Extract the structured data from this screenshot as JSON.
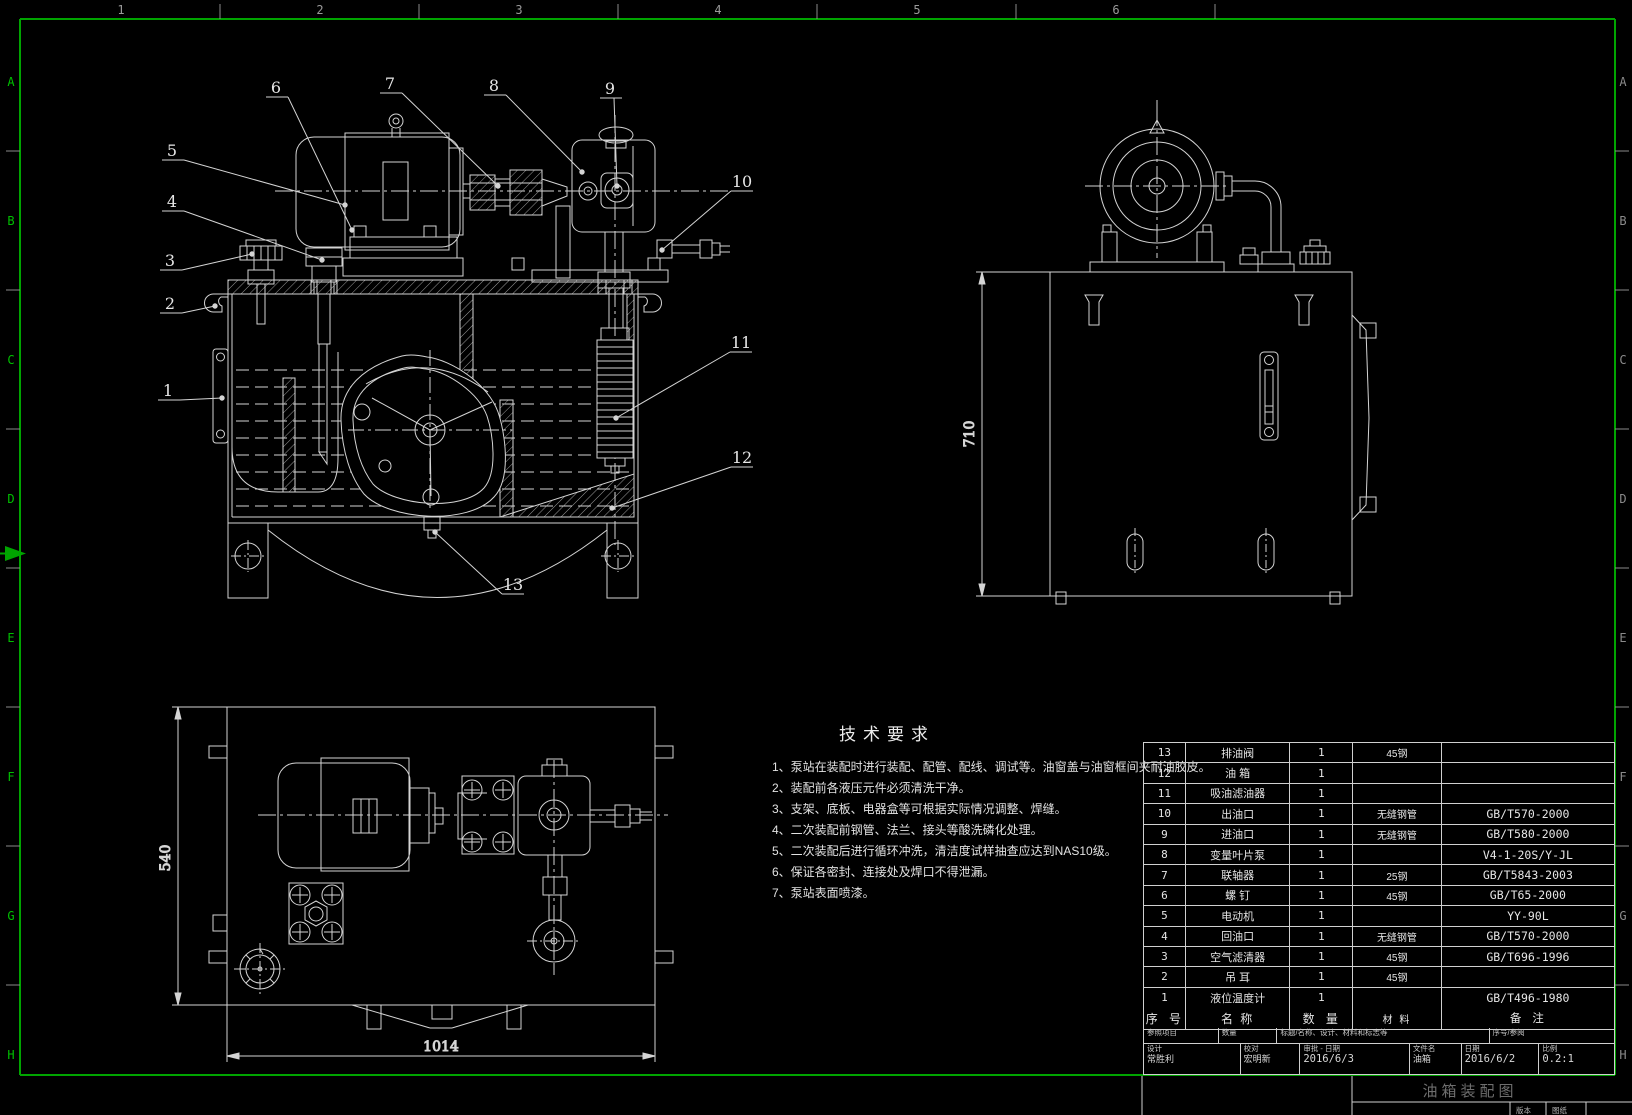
{
  "frame": {
    "columns": [
      "1",
      "2",
      "3",
      "4",
      "5",
      "6"
    ],
    "rows_left": [
      "A",
      "B",
      "C",
      "D",
      "E",
      "F",
      "G",
      "H"
    ],
    "rows_right": [
      "A",
      "B",
      "C",
      "D",
      "E",
      "F",
      "G",
      "H"
    ]
  },
  "tech_requirements": {
    "title": "技术要求",
    "items": [
      "1、泵站在装配时进行装配、配管、配线、调试等。油窗盖与油窗框间夹耐油胶皮。",
      "2、装配前各液压元件必须清洗干净。",
      "3、支架、底板、电器盒等可根据实际情况调整、焊缝。",
      "4、二次装配前钢管、法兰、接头等酸洗磷化处理。",
      "5、二次装配后进行循环冲洗，清洁度试样抽查应达到NAS10级。",
      "6、保证各密封、连接处及焊口不得泄漏。",
      "7、泵站表面喷漆。"
    ]
  },
  "front_view": {
    "balloons": [
      "1",
      "2",
      "3",
      "4",
      "5",
      "6",
      "7",
      "8",
      "9",
      "10",
      "11",
      "12",
      "13"
    ]
  },
  "side_view": {
    "height_dim": "710"
  },
  "top_view": {
    "height_dim": "540",
    "width_dim": "1014"
  },
  "parts_table": {
    "headers": [
      "序  号",
      "名  称",
      "数  量",
      "材  料",
      "备  注"
    ],
    "rows": [
      {
        "no": "13",
        "name": "排油阀",
        "qty": "1",
        "material": "45钢",
        "note": ""
      },
      {
        "no": "12",
        "name": "油  箱",
        "qty": "1",
        "material": "",
        "note": ""
      },
      {
        "no": "11",
        "name": "吸油滤油器",
        "qty": "1",
        "material": "",
        "note": ""
      },
      {
        "no": "10",
        "name": "出油口",
        "qty": "1",
        "material": "无缝钢管",
        "note": "GB/T570-2000"
      },
      {
        "no": "9",
        "name": "进油口",
        "qty": "1",
        "material": "无缝钢管",
        "note": "GB/T580-2000"
      },
      {
        "no": "8",
        "name": "变量叶片泵",
        "qty": "1",
        "material": "",
        "note": "V4-1-20S/Y-JL"
      },
      {
        "no": "7",
        "name": "联轴器",
        "qty": "1",
        "material": "25钢",
        "note": "GB/T5843-2003"
      },
      {
        "no": "6",
        "name": "螺  钉",
        "qty": "1",
        "material": "45钢",
        "note": "GB/T65-2000"
      },
      {
        "no": "5",
        "name": "电动机",
        "qty": "1",
        "material": "",
        "note": "YY-90L"
      },
      {
        "no": "4",
        "name": "回油口",
        "qty": "1",
        "material": "无缝钢管",
        "note": "GB/T570-2000"
      },
      {
        "no": "3",
        "name": "空气滤清器",
        "qty": "1",
        "material": "45钢",
        "note": "GB/T696-1996"
      },
      {
        "no": "2",
        "name": "吊  耳",
        "qty": "1",
        "material": "45钢",
        "note": ""
      },
      {
        "no": "1",
        "name": "液位温度计",
        "qty": "1",
        "material": "",
        "note": "GB/T496-1980"
      }
    ]
  },
  "title_block": {
    "ref_label": "参照项目",
    "qty_label": "数量",
    "std_label": "标题/名称、设计、材料和标志等",
    "serial_label": "序号/参阅",
    "design_label": "设计",
    "design_value": "常胜利",
    "check_label": "校对",
    "check_value": "宏明新",
    "approve_label": "审批 - 日期",
    "approve_value": "2016/6/3",
    "file_label": "文件名",
    "file_value": "油箱",
    "date_label": "日期",
    "date_value": "2016/6/2",
    "scale_label": "比例",
    "scale_value": "0.2:1"
  },
  "footer": {
    "drawing_title": "油箱装配图",
    "version_label": "版本",
    "sheet_label": "图纸"
  }
}
